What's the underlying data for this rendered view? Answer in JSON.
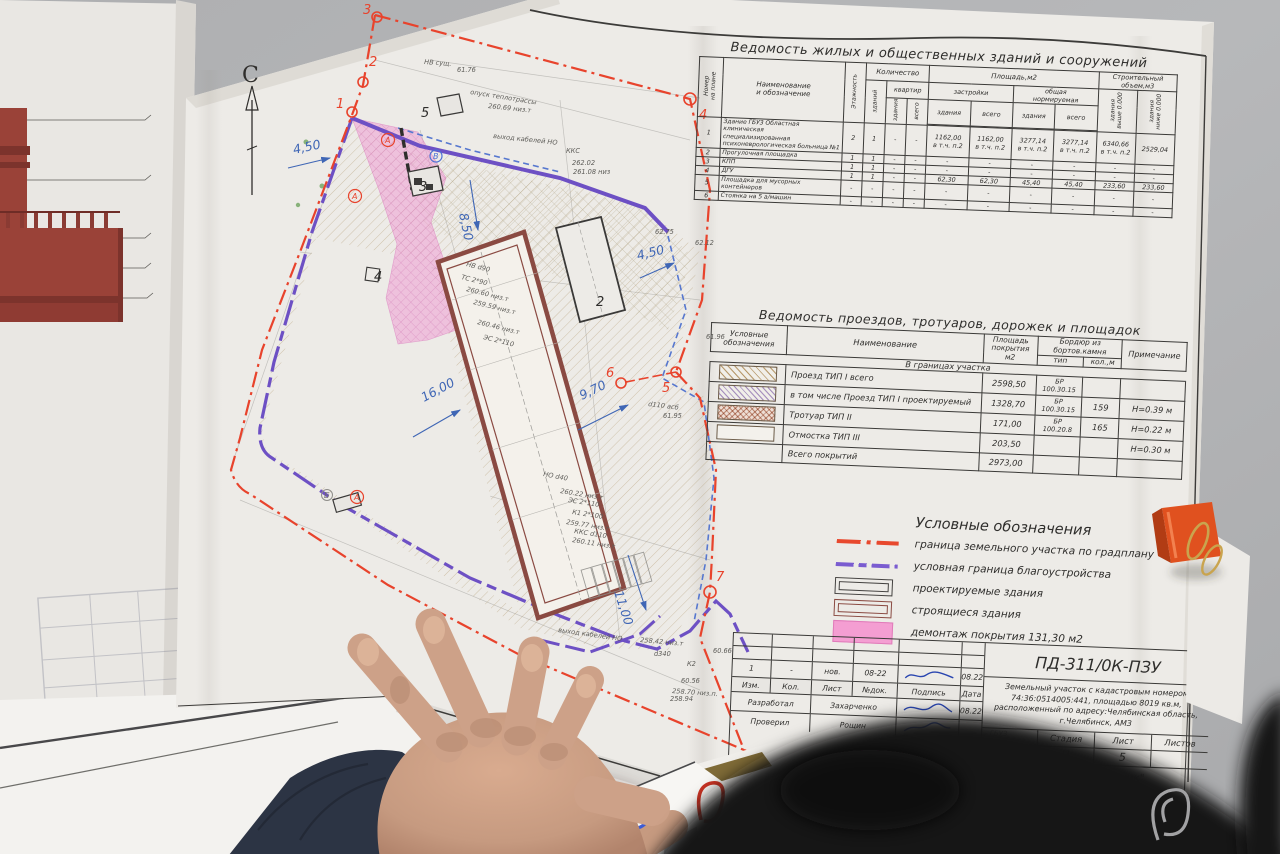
{
  "plan": {
    "north": "С",
    "pts": [
      "1",
      "2",
      "3",
      "4",
      "5",
      "6",
      "7"
    ],
    "bld": [
      "2",
      "3",
      "4",
      "5"
    ],
    "axes": [
      "А",
      "А",
      "В",
      "А",
      "Б"
    ],
    "dims": [
      "4,50",
      "8,50",
      "4,50",
      "16,00",
      "9,70",
      "11,00"
    ],
    "ann": [
      "НВ сущ.",
      "опуск теплотрассы",
      "260.69 низ.т",
      "выход кабелей НО",
      "ККС",
      "262.02",
      "261.08 низ",
      "НВ d90",
      "ТС 2*90",
      "260.60 низ.т",
      "259.59 низ.т",
      "260.46 низ.т",
      "ЭС 2*110",
      "НО d40",
      "260.22 низ.т",
      "ЭС 2*110",
      "К1 2*100",
      "259.77 низ.т",
      "ККС d110",
      "260.11 низ.т",
      "d110 асб",
      "61.95",
      "258.42 низ.т",
      "d340",
      "К2",
      "60.56",
      "258.70 низ.п.",
      "258.94",
      "60.66",
      "выход кабелей НО",
      "61.76",
      "62.12",
      "61.96",
      "62.75"
    ]
  },
  "table1": {
    "title": "Ведомость жилых и общественных зданий и сооружений",
    "h": {
      "num": "Номер\nна плане",
      "name": "Наименование\nи обозначение",
      "floors": "Этажность",
      "qty": "Количество",
      "qty_bld": "зданий",
      "qty_apt": "квартир",
      "area": "Площадь,м2",
      "area_built": "застройки",
      "area_norm": "общая\nнормируемая",
      "bld": "здания",
      "total": "всего",
      "vol": "Строительный\nобъем,м3",
      "vol_above": "здания\nвыше 0.000",
      "vol_below": "здания\nниже 0.000"
    },
    "rows": [
      {
        "n": "1",
        "name": "Здание ГБУЗ Областная клиническая\nспециализированная\nпсихоневрологическая больница №1",
        "fl": "2",
        "zd": "1",
        "kz": "-",
        "kv": "-",
        "az": "1162,00\nв т.ч. п.2",
        "av": "1162,00\nв т.ч. п.2",
        "nz": "3277,14\nв т.ч. п.2",
        "nv": "3277,14\nв т.ч. п.2",
        "va": "6340,66\nв т.ч. п.2",
        "vb": "2529,04"
      },
      {
        "n": "2",
        "name": "Прогулочная площадка",
        "fl": "1",
        "zd": "1",
        "kz": "-",
        "kv": "-",
        "az": "-",
        "av": "-",
        "nz": "-",
        "nv": "-",
        "va": "-",
        "vb": "-"
      },
      {
        "n": "3",
        "name": "КПП",
        "fl": "1",
        "zd": "1",
        "kz": "-",
        "kv": "-",
        "az": "-",
        "av": "-",
        "nz": "-",
        "nv": "-",
        "va": "-",
        "vb": "-"
      },
      {
        "n": "4",
        "name": "ДГУ",
        "fl": "1",
        "zd": "1",
        "kz": "-",
        "kv": "-",
        "az": "62,30",
        "av": "62,30",
        "nz": "45,40",
        "nv": "45,40",
        "va": "233,60",
        "vb": "233,60"
      },
      {
        "n": "5",
        "name": "Площадка для мусорных контейнеров",
        "fl": "-",
        "zd": "-",
        "kz": "-",
        "kv": "-",
        "az": "-",
        "av": "-",
        "nz": "-",
        "nv": "-",
        "va": "-",
        "vb": "-"
      },
      {
        "n": "6",
        "name": "Стоянка на 5 а/машин",
        "fl": "-",
        "zd": "-",
        "kz": "-",
        "kv": "-",
        "az": "-",
        "av": "-",
        "nz": "-",
        "nv": "-",
        "va": "-",
        "vb": "-"
      }
    ]
  },
  "table2": {
    "title": "Ведомость проездов, тротуаров, дорожек и площадок",
    "h": {
      "sym": "Условные\nобозначения",
      "name": "Наименование",
      "area": "Площадь\nпокрытия\nм2",
      "curb": "Бордюр из\nбортов.камня",
      "tip": "тип",
      "kol": "кол.,м",
      "note": "Примечание"
    },
    "section_label": "В границах участка",
    "rows": [
      {
        "swatch": "sw-h1",
        "name": "Проезд ТИП I всего",
        "area": "2598,50",
        "tip": "БР\n100.30.15",
        "kol": "",
        "note": ""
      },
      {
        "swatch": "sw-h2",
        "name": "в том числе Проезд ТИП I проектируемый",
        "area": "1328,70",
        "tip": "БР\n100.30.15",
        "kol": "159",
        "note": "Н=0.39 м"
      },
      {
        "swatch": "sw-x",
        "name": "Тротуар ТИП II",
        "area": "171,00",
        "tip": "БР\n100.20.8",
        "kol": "165",
        "note": "Н=0.22 м"
      },
      {
        "swatch": "sw-e",
        "name": "Отмостка ТИП III",
        "area": "203,50",
        "tip": "",
        "kol": "",
        "note": "Н=0.30 м"
      },
      {
        "swatch": "sw-n",
        "name": "Всего покрытий",
        "area": "2973,00",
        "tip": "",
        "kol": "",
        "note": ""
      }
    ]
  },
  "legend": {
    "title": "Условные обозначения",
    "items": [
      {
        "label": "граница земельного участка по градплану"
      },
      {
        "label": "условная граница благоустройства"
      },
      {
        "label": "проектируемые здания"
      },
      {
        "label": "строящиеся здания"
      },
      {
        "label": "демонтаж покрытия 131,30 м2"
      }
    ]
  },
  "title_block": {
    "doc": "ПД-311/0К-ПЗУ",
    "desc": "Земельный участок с кадастровым номером 74:36:0514005:441,\nплощадью 8019 кв.м, расположенный по адресу:Челябинская область,\nг.Челябинск, АМЗ",
    "rev": {
      "izm": "1",
      "kol": "-",
      "list": "нов.",
      "doc": "08-22",
      "date": "08.22"
    },
    "hdr": [
      "Изм.",
      "Кол.",
      "Лист",
      "№док.",
      "Подпись",
      "Дата"
    ],
    "dev_label": "Разработал",
    "dev_name": "Захарченко",
    "dev_date": "08.22",
    "chk_label": "Проверил",
    "chk_name": "Рощин",
    "chk_date": "",
    "stage_h": [
      "Стадия",
      "Лист",
      "Листов"
    ],
    "stage_v": [
      "П",
      "5",
      ""
    ],
    "company": "ООО \"Монтажник\"",
    "faint": [
      "ГБУЗ",
      "клиническая",
      "ологическая"
    ],
    "faint2": "контроль"
  },
  "colors": {
    "boundary_red": "#e8432c",
    "improvement_violet": "#6d50c4",
    "demolition_pink": "#f0a0d3",
    "building_brown": "#8a4a42",
    "dimension_blue": "#3f66b5"
  }
}
